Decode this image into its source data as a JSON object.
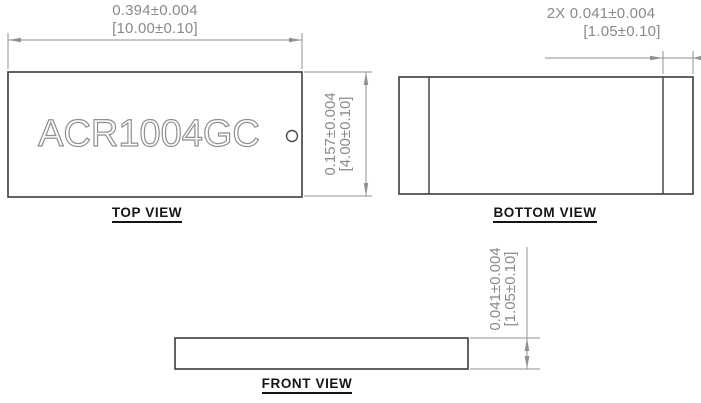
{
  "drawing": {
    "part_number": "ACR1004GC",
    "colors": {
      "outline": "#3c3c3c",
      "dimension": "#8a8a8a",
      "label": "#161616"
    },
    "views": {
      "top": {
        "label": "TOP VIEW",
        "width_dim": {
          "inch": "0.394±0.004",
          "mm": "[10.00±0.10]"
        },
        "height_dim": {
          "inch": "0.157±0.004",
          "mm": "[4.00±0.10]"
        }
      },
      "bottom": {
        "label": "BOTTOM VIEW",
        "pad_dim": {
          "inch": "2X 0.041±0.004",
          "mm": "[1.05±0.10]"
        }
      },
      "front": {
        "label": "FRONT VIEW",
        "thickness_dim": {
          "inch": "0.041±0.004",
          "mm": "[1.05±0.10]"
        }
      }
    }
  }
}
